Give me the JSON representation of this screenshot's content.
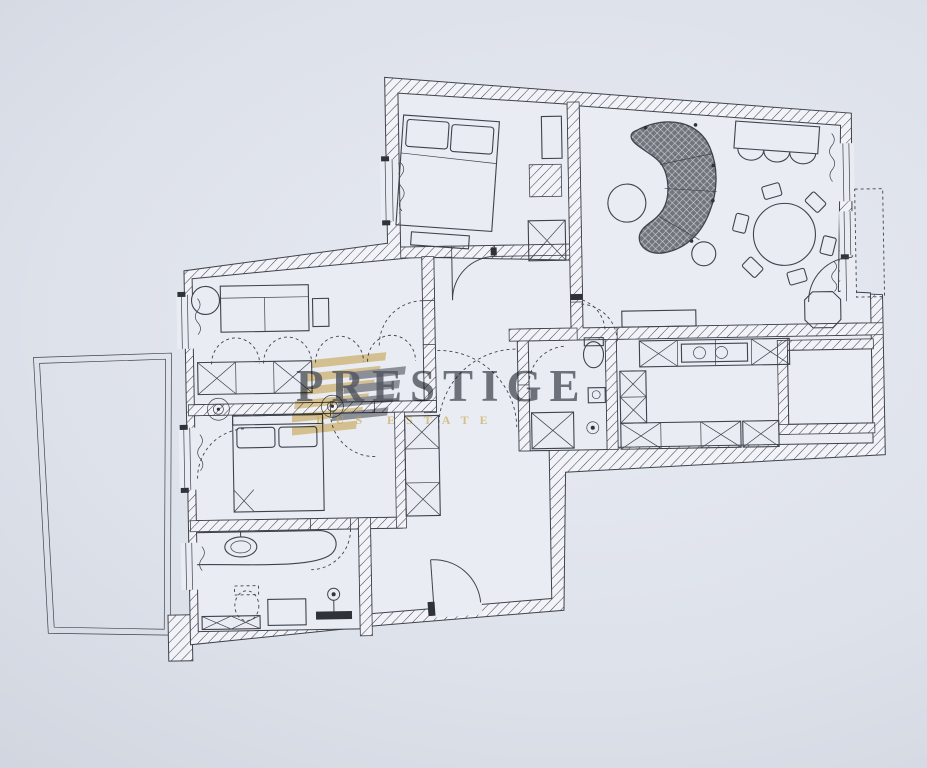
{
  "watermark": {
    "brand": "PRESTIGE",
    "subtitle": "RUS ESTATE"
  },
  "colors": {
    "background": "#ccd1db",
    "paper": "#e9ecf3",
    "wall_fill": "#f2f3f8",
    "line": "#3f434b",
    "dark": "#2f3237",
    "sofa_fill": "#70747b",
    "sofa_mesh": "#d3d5da",
    "gold": "#d9b659",
    "gold_soft": "#e3c377",
    "brand_gray": "#565a61"
  },
  "floor_plan": {
    "type": "apartment-floor-plan",
    "wall_style": "diagonal-hatch",
    "rooms": [
      {
        "name": "bedroom-1",
        "furniture": [
          "double-bed",
          "pillows",
          "foot-bench",
          "wardrobe-box",
          "closet-x-box"
        ]
      },
      {
        "name": "living-room",
        "furniture": [
          "curved-sofa",
          "coffee-table",
          "side-table",
          "dining-table",
          "dining-chairs-x6",
          "loveseat",
          "console",
          "pouf-octagon"
        ]
      },
      {
        "name": "study",
        "furniture": [
          "sofa",
          "round-side-table",
          "hanging-wardrobe-arcs",
          "closet-row",
          "ceiling-light",
          "ceiling-light"
        ]
      },
      {
        "name": "bedroom-2",
        "furniture": [
          "double-bed",
          "headboard",
          "wardrobe-column"
        ]
      },
      {
        "name": "bathroom",
        "furniture": [
          "vanity-counter",
          "washbasin",
          "toilet",
          "shower-tray",
          "cabinet-bench",
          "pedestal-light"
        ]
      },
      {
        "name": "wc",
        "furniture": [
          "toilet",
          "washbasin",
          "shower-x-box",
          "ceiling-light"
        ]
      },
      {
        "name": "kitchen",
        "furniture": [
          "upper-counter-cabinets",
          "cooktop",
          "base-cabinets",
          "appliance-box"
        ]
      },
      {
        "name": "utility-room",
        "furniture": []
      },
      {
        "name": "hallway",
        "furniture": [
          "built-in-wardrobe",
          "crossing-door-arcs"
        ]
      },
      {
        "name": "terrace",
        "furniture": []
      },
      {
        "name": "balcony",
        "furniture": []
      }
    ]
  }
}
